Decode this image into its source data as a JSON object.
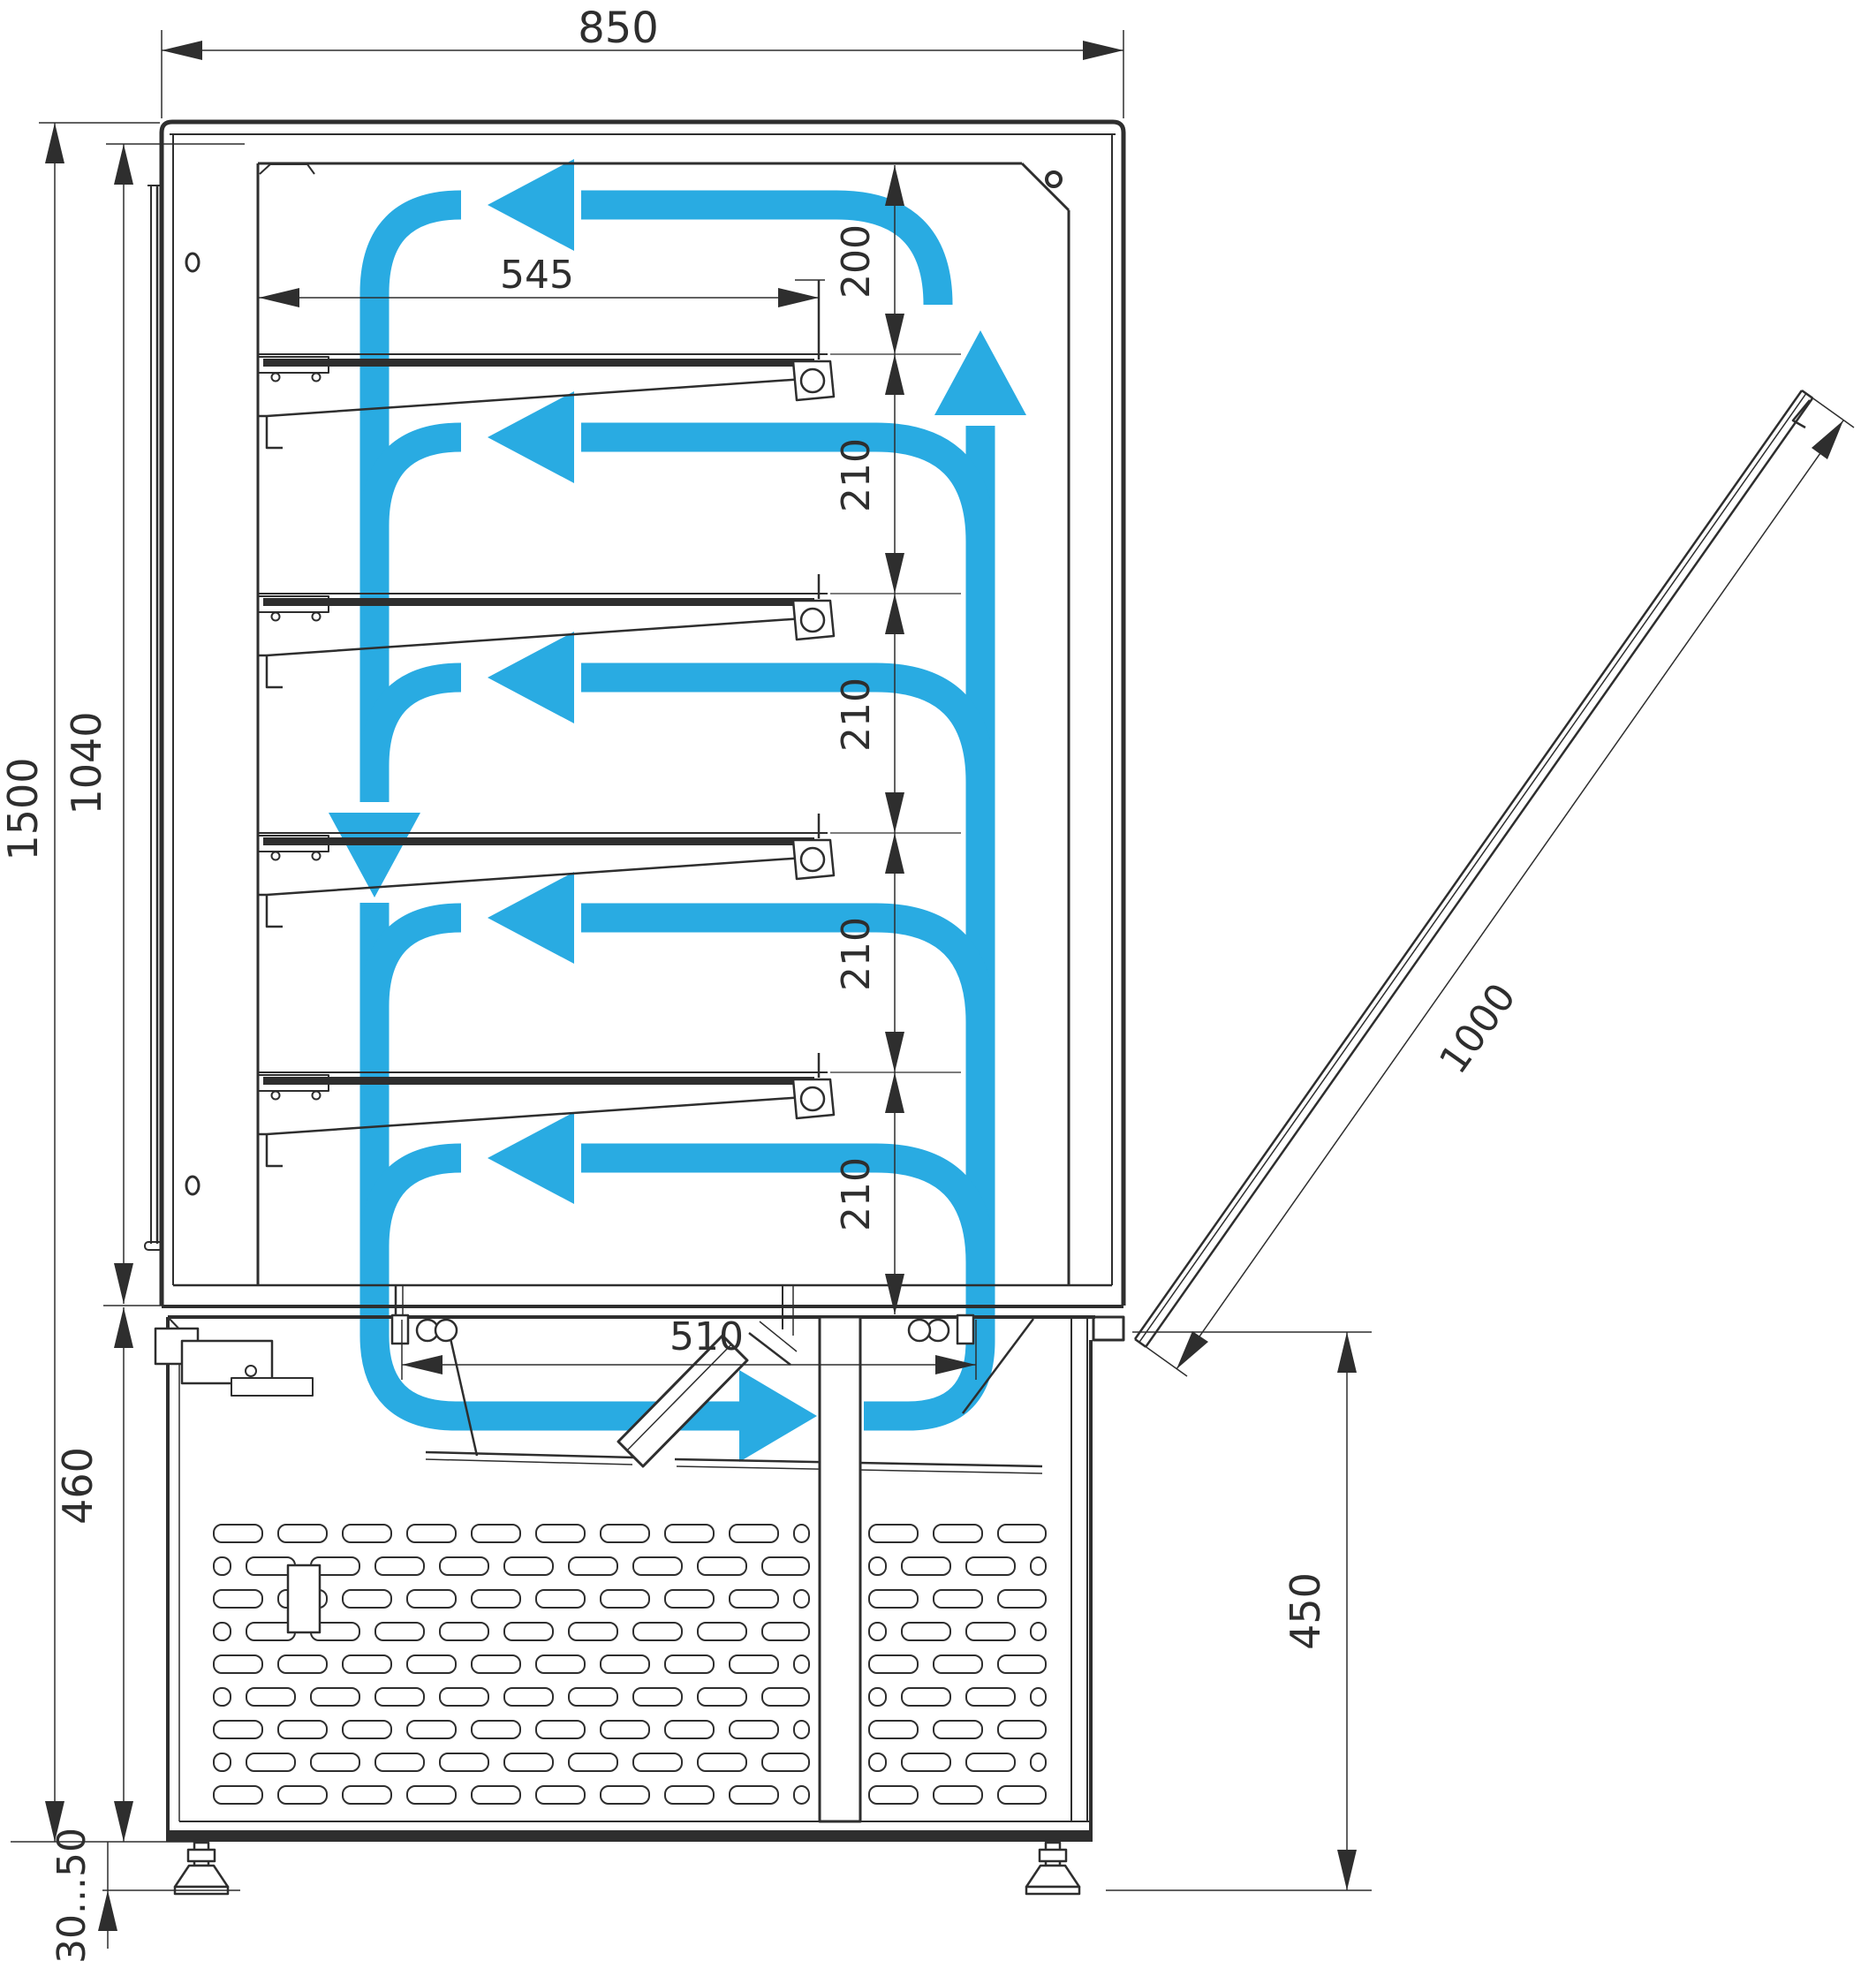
{
  "drawing": {
    "type": "technical-cross-section",
    "subject": "refrigerated confectionery display case side section with airflow circulation",
    "colors": {
      "airflow": "#29abe2",
      "line": "#2e2e2e",
      "background": "#ffffff"
    },
    "dimensions": {
      "overall_width": "850",
      "shelf_length": "545",
      "top_clearance": "200",
      "shelf_spacings": [
        "210",
        "210",
        "210",
        "210"
      ],
      "bottom_opening": "510",
      "overall_height": "1500",
      "display_section_height": "1040",
      "base_section_height": "460",
      "foot_adjustment": "30...50",
      "base_height_right": "450",
      "door_length": "1000"
    }
  }
}
